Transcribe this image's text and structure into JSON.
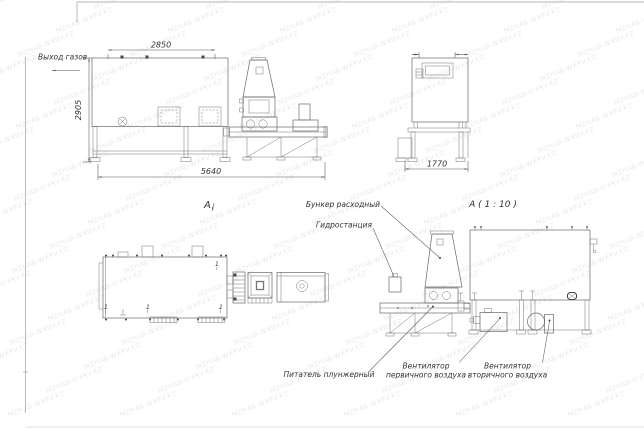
{
  "sheet": {
    "background": "#ffffff",
    "line_color": "#6a6a6a"
  },
  "watermark": {
    "text": "MZHAB-WXRV.KZ",
    "angle": -22,
    "color": "#8f8f8f",
    "opacity": 0.2,
    "cols": 7,
    "rows": 18,
    "dx": 112,
    "dy": 24,
    "stagger": 38
  },
  "views": {
    "side_elevation": {
      "dim_top_width": "2850",
      "dim_height": "2905",
      "dim_total_length": "5640",
      "label_gas_outlet": "Выход газов"
    },
    "end_elevation": {
      "dim_depth": "1770"
    },
    "plan": {
      "label": "А",
      "position_mark": "1"
    },
    "detail": {
      "title": "А ( 1 : 10 )",
      "label_feed_hopper": "Бункер расходный",
      "label_hydraulic_station": "Гидростанция",
      "label_plunger_feeder": "Питатель плунжерный",
      "label_primary_fan_line1": "Вентилятор",
      "label_primary_fan_line2": "первичного воздуха",
      "label_secondary_fan_line1": "Вентилятор",
      "label_secondary_fan_line2": "вторичного воздуха"
    }
  }
}
